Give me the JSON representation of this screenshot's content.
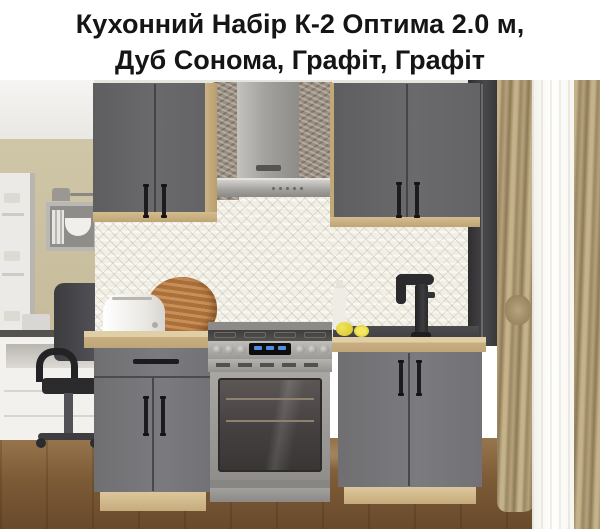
{
  "title": {
    "line1": "Кухонний Набір К-2 Оптима 2.0 м,",
    "line2": "Дуб Сонома, Графіт, Графіт"
  },
  "palette": {
    "cabinet_graphite": "#69696c",
    "oak_sonoma_frame": "#cdb384",
    "wall_beige": "#c8bd9c",
    "backsplash_tile": "#f2efe6",
    "stainless_steel": "#a9a7a3",
    "window_frame": "#3b3a3c",
    "curtain_tan": "#b5a27c",
    "sheer_white": "#fdfcf9",
    "floor_wood": "#7d5b37",
    "handle_black": "#1c1c1e",
    "stove_display_blue": "#4f8fe0",
    "lemon_yellow": "#ecd943"
  }
}
